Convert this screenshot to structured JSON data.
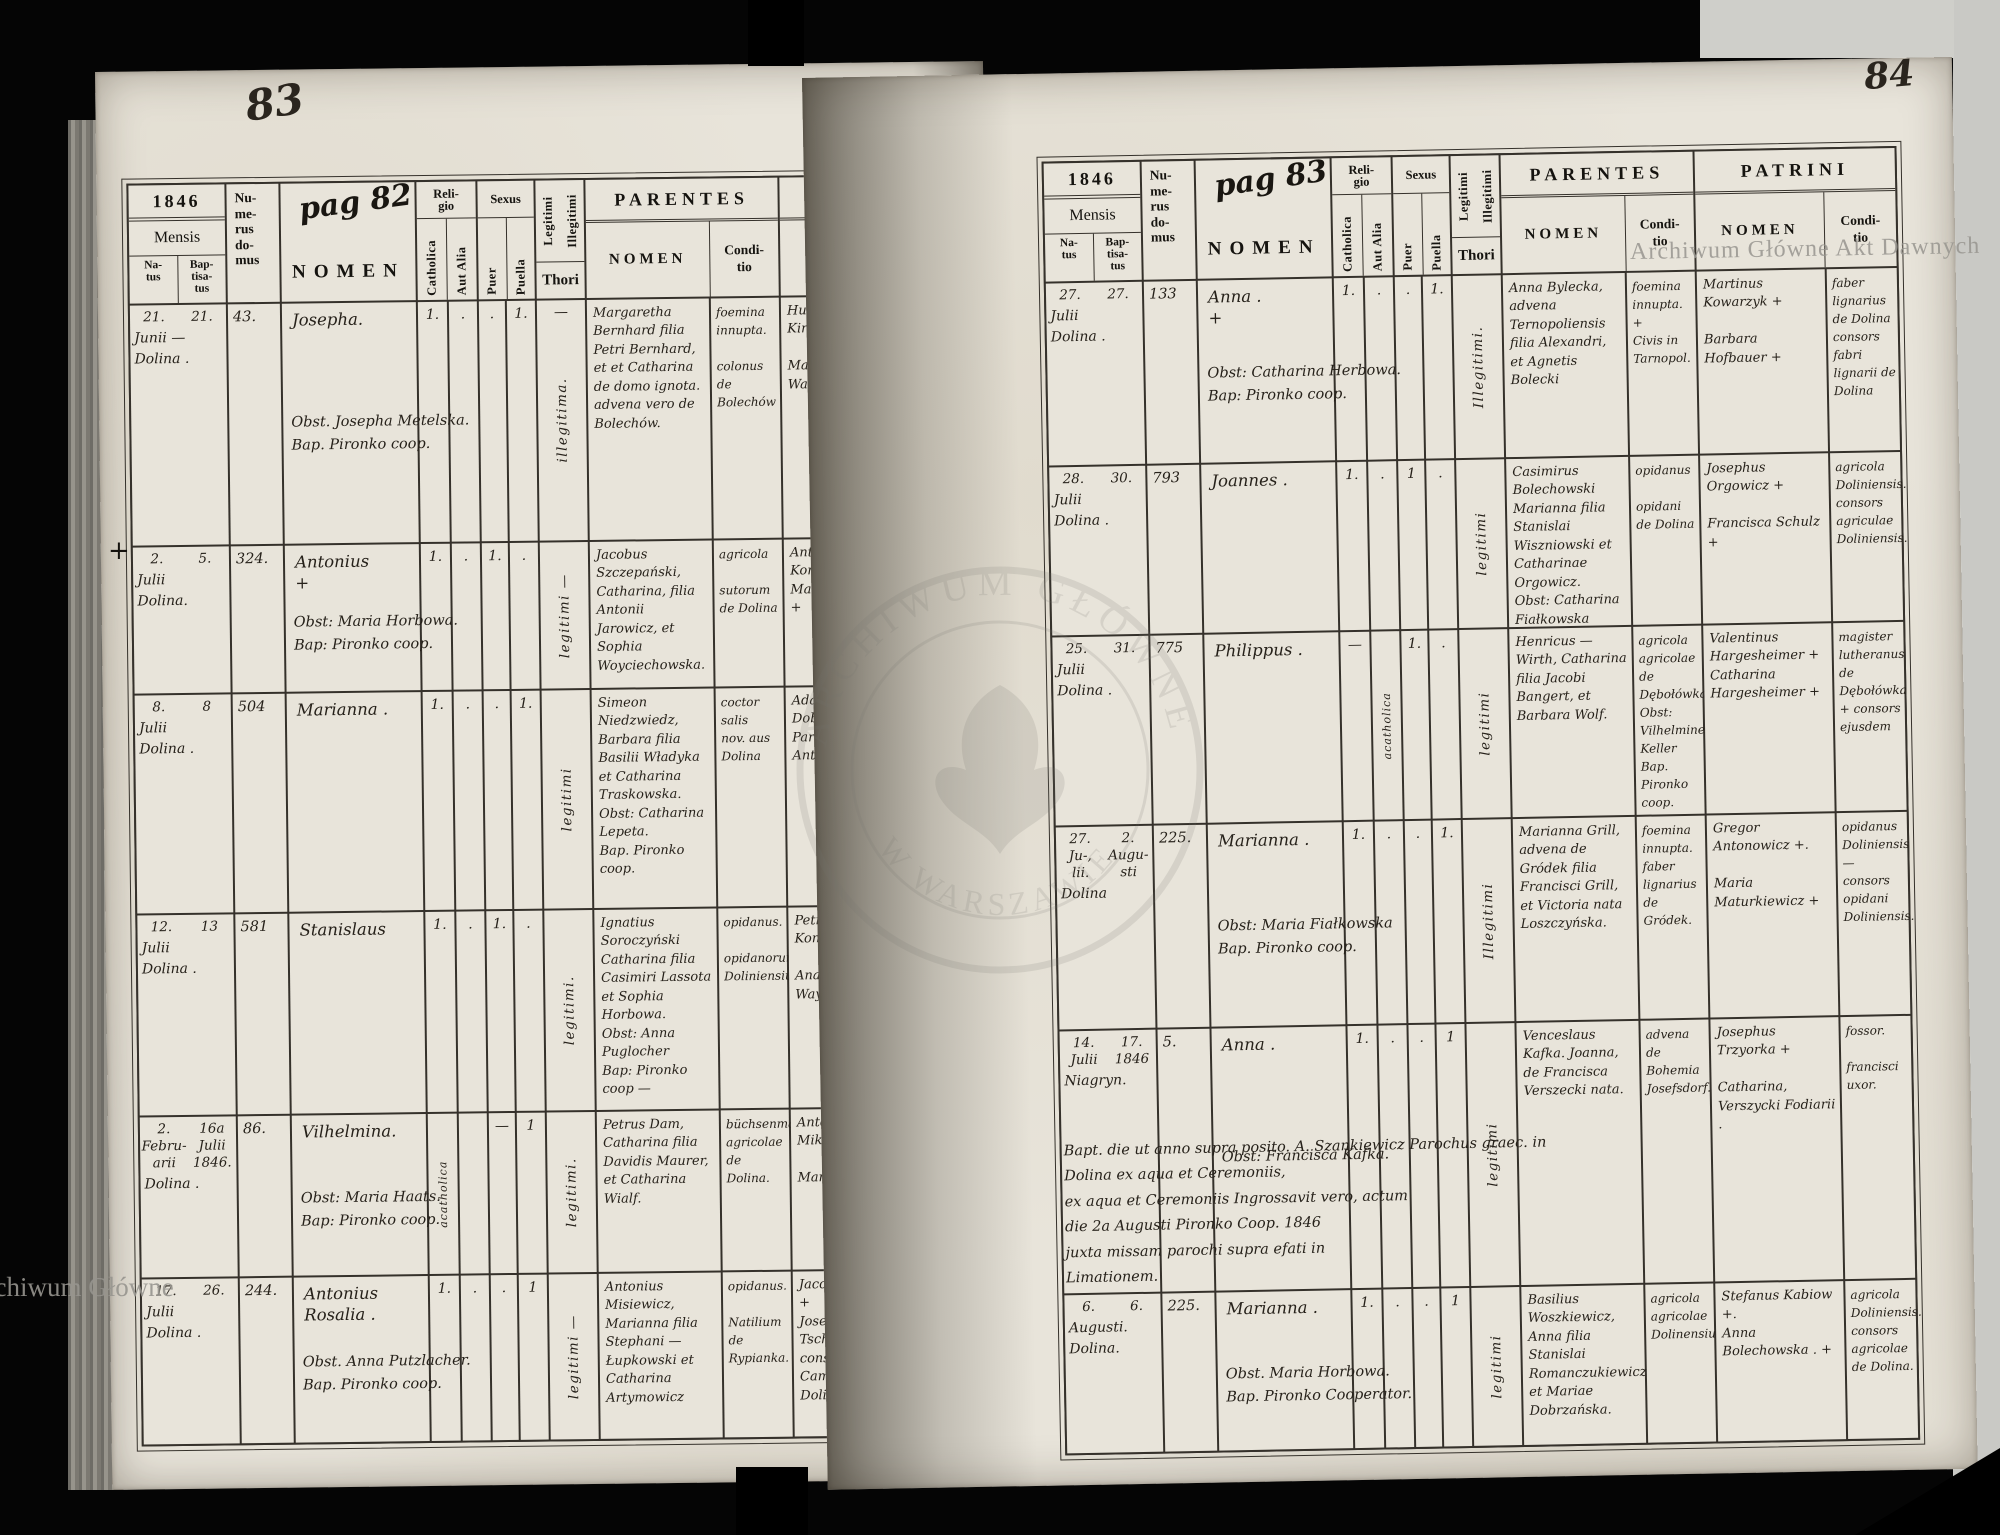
{
  "header": {
    "year": "1846",
    "mensis": "Mensis",
    "natus": "Na-\ntus",
    "baptisatus": "Bap-\ntisa-\ntus",
    "numerus": "Nu-\nme-\nrus\ndo-\nmus",
    "nomen": "NOMEN",
    "religio": "Reli-\ngio",
    "catholica": "Catholica",
    "aut_alia": "Aut Alia",
    "sexus": "Sexus",
    "puer": "Puer",
    "puella": "Puella",
    "legitimi": "Legitimi",
    "illegitimi": "Illegitimi",
    "thori": "Thori",
    "parentes": "PARENTES",
    "patrini": "PATRINI",
    "sub_nomen": "NOMEN",
    "conditio": "Condi-\ntio"
  },
  "watermarks": {
    "top_right": "Archiwum Główne Akt Dawnych",
    "bottom_left": "Archiwum Główne",
    "stamp_top": "ARCHIWUM GŁÓWNE",
    "stamp_bottom": "W WARSZAWIE"
  },
  "left_page": {
    "page_number": "83",
    "pag_note": "pag 82",
    "margin_mark": "+",
    "rows": [
      {
        "natus_day": "21.",
        "bapt_day": "21.",
        "date_rest": "Junii —\nDolina .",
        "house": "43.",
        "name": "Josepha.",
        "name_note": "Obst. Josepha Metelska.\nBap. Pironko coop.",
        "cath": "1.",
        "alia": ".",
        "puer": ".",
        "puella": "1.",
        "thori": "—",
        "legit": "illegitima.",
        "parentes": "Margaretha Bernhard filia Petri Bernhard, et et Catharina de domo ignota. advena vero de Bolechów.",
        "par_cond": "foemina innupta.\n\ncolonus de Bolechów",
        "patrini": "Hubert Kirchmaier +\n\nMagdalena Waimann +",
        "pat_cond": "pauperin der aufseher aus Dolina\ngespanis des pfleghers act Dolina"
      },
      {
        "natus_day": "2.",
        "bapt_day": "5.",
        "date_rest": "Julii\nDolina.",
        "house": "324.",
        "name": "Antonius\n      +",
        "name_note": "Obst: Maria Horbowa.\nBap:  Pironko coop.",
        "cath": "1.",
        "alia": ".",
        "puer": "1.",
        "puella": ".",
        "thori": "",
        "legit": "legitimi —",
        "parentes": "Jacobus Szczepański, Catharina, filia Antonii Jarowicz, et Sophia Woyciechowska.",
        "par_cond": "agricola\n\nsutorum de Dolina",
        "patrini": "Antonius Kordecki +\nMaria Paprocka. +",
        "pat_cond": "agricola Doliniensis.\nconsors agricolae de Dolinae"
      },
      {
        "natus_day": "8.",
        "bapt_day": "8",
        "date_rest": "Julii\nDolina .",
        "house": "504",
        "name": "Marianna .",
        "name_note": "",
        "cath": "1.",
        "alia": ".",
        "puer": ".",
        "puella": "1.",
        "thori": "",
        "legit": "legitimi",
        "parentes": "Simeon Niedzwiedz, Barbara filia Basilii Władyka et Catharina Traskowska.\nObst: Catharina Lepeta.\nBap.  Pironko coop.",
        "par_cond": "coctor salis\nnov. aus Dolina",
        "patrini": "Adalbertus Dobrański +\nParasceva Antonowicz +",
        "pat_cond": "lado de Dolina\nconsors coctoris salis de Dolina."
      },
      {
        "natus_day": "12.",
        "bapt_day": "13",
        "date_rest": "Julii\nDolina .",
        "house": "581",
        "name": "Stanislaus",
        "name_note": "",
        "cath": "1.",
        "alia": ".",
        "puer": "1.",
        "puella": ".",
        "thori": "",
        "legit": "legitimi.",
        "parentes": "Ignatius Soroczyński Catharina filia Casimiri Lassota et Sophia Horbowa.\nObst:  Anna Puglocher\nBap:  Pironko coop —",
        "par_cond": "opidanus.\n\nopidanorum Doliniensium.",
        "patrini": "Petrus Komarnicki +\n\nAnastasia Waymann +",
        "pat_cond": "opidanus Doliniensis.\nconsors adiutoris scholae trivialis Doliniensis"
      },
      {
        "natus_day": "2.\nFebru-\narii",
        "bapt_day": "16a\nJulii\n1846.",
        "date_rest": "Dolina .",
        "house": "86.",
        "name": "Vilhelmina.",
        "name_note": "Obst:  Maria Haats.\nBap:  Pironko coop.",
        "cath": "acatholica",
        "alia": "",
        "puer": "—",
        "puella": "1",
        "thori": "",
        "legit": "legitimi.",
        "parentes": "Petrus Dam, Catharina filia Davidis Maurer, et Catharina Wialf.",
        "par_cond": "büchsenmacher\nagricolae de Dolina.",
        "patrini": "Antonius Mikulski +\n\nMaria Haats +",
        "pat_cond": "sutor\n\nconsors opidani de Dolna"
      },
      {
        "natus_day": "17.",
        "bapt_day": "26.",
        "date_rest": "Julii\nDolina .",
        "house": "244.",
        "name": "Antonius\nRosalia .",
        "name_note": "Obst. Anna Putzlacher.\nBap.  Pironko coop.",
        "cath": "1.",
        "alia": ".",
        "puer": ".",
        "puella": "1",
        "thori": "",
        "legit": "legitimi —",
        "parentes": "Antonius Misiewicz, Marianna filia Stephani — Łupkowski et Catharina Artymowicz",
        "par_cond": "opidanus.\n\nNatilium de Rypianka.",
        "patrini": "Jacobus Waiman +\nJosepha Tschernek +\nconsors Camerarii civilis Dolinensis —",
        "pat_cond": "coadiutor magisterii scholae trivialis in Dolina"
      }
    ]
  },
  "right_page": {
    "page_number": "84",
    "pag_note": "pag 83",
    "rows": [
      {
        "natus_day": "27.",
        "bapt_day": "27.",
        "date_rest": "Julii\nDolina .",
        "house": "133",
        "name": "Anna .\n    +",
        "name_note": "Obst: Catharina Herbowa.\nBap:  Pironko coop.",
        "cath": "1.",
        "alia": ".",
        "puer": ".",
        "puella": "1.",
        "thori": "",
        "legit": "Illegitimi.",
        "parentes": "Anna Bylecka, advena Ternopoliensis filia Alexandri, et Agnetis Bolecki",
        "par_cond": "foemina innupta. +\nCivis in Tarnopol.",
        "patrini": "Martinus Kowarzyk +\n\nBarbara Hofbauer +",
        "pat_cond": "faber lignarius de Dolina\nconsors fabri lignarii de Dolina"
      },
      {
        "natus_day": "28.",
        "bapt_day": "30.",
        "date_rest": "Julii\nDolina .",
        "house": "793",
        "name": "Joannes .",
        "name_note": "",
        "cath": "1.",
        "alia": ".",
        "puer": "1",
        "puella": ".",
        "thori": "",
        "legit": "legitimi",
        "parentes": "Casimirus Bolechowski Marianna filia Stanislai Wiszniowski et Catharinae Orgowicz.\nObst: Catharina Fiałkowska\nBap. Pironko coop",
        "par_cond": "opidanus\n\nopidani de Dolina",
        "patrini": "Josephus Orgowicz +\n\nFrancisca Schulz +",
        "pat_cond": "agricola Doliniensis.\nconsors agriculae Doliniensis."
      },
      {
        "natus_day": "25.",
        "bapt_day": "31.",
        "date_rest": "Julii\nDolina .",
        "house": "775",
        "name": "Philippus .",
        "name_note": "",
        "cath": "—",
        "alia": "acatholica",
        "puer": "1.",
        "puella": ".",
        "thori": "",
        "legit": "legitimi",
        "parentes": "Henricus — Wirth, Catharina filia Jacobi Bangert, et Barbara Wolf.",
        "par_cond": "agricola\nagricolae de Dębołówka.\nObst: Vilhelmine Keller\nBap. Pironko coop.",
        "patrini": "Valentinus Hargesheimer +\nCatharina Hargesheimer +",
        "pat_cond": "magister lutheranus de Dębołówka\n+ consors ejusdem"
      },
      {
        "natus_day": "27.\nJu-,\nlii.",
        "bapt_day": "2.\nAugu-\nsti",
        "date_rest": "Dolina",
        "house": "225.",
        "name": "Marianna .",
        "name_note": "Obst:  Maria Fiałkowska\nBap.  Pironko coop.",
        "cath": "1.",
        "alia": ".",
        "puer": ".",
        "puella": "1.",
        "thori": "",
        "legit": "Illegitimi",
        "parentes": "Marianna Grill, advena de Gródek filia Francisci Grill, et Victoria nata Loszczyńska.",
        "par_cond": "foemina innupta.\nfaber lignarius de Gródek.",
        "patrini": "Gregor Antonowicz +.\n\nMaria Maturkiewicz +",
        "pat_cond": "opidanus Doliniensis —\nconsors opidani Doliniensis."
      },
      {
        "natus_day": "14.\nJulii",
        "bapt_day": "17.\n1846",
        "date_rest": "Niagryn.",
        "house": "5.",
        "name": "Anna .",
        "name_note": "Obst: Francisca Kafka.",
        "note": "Bapt. die ut anno supra posito. A. Szankiewicz Parochus graec. in Dolina ex aqua et Ceremoniis,\nex aqua et Ceremoniis Ingrossavit vero, actum\ndie 2a Augusti Pironko Coop. 1846\njuxta missam parochi supra efati in\nLimationem.",
        "cath": "1.",
        "alia": ".",
        "puer": ".",
        "puella": "1",
        "thori": "",
        "legit": "legitimi",
        "parentes": "Venceslaus Kafka. Joanna, de Francisca Verszecki nata.",
        "par_cond": "advena de Bohemia Josefsdorf.",
        "patrini": "Josephus Trzyorka +\n\nCatharina, Verszycki Fodiarii .",
        "pat_cond": "fossor.\n\nfrancisci uxor."
      },
      {
        "natus_day": "6.",
        "bapt_day": "6.",
        "date_rest": "Augusti.\nDolina.",
        "house": "225.",
        "name": "Marianna .",
        "name_note": "Obst. Maria Horbowa.\nBap. Pironko Cooperator.",
        "cath": "1.",
        "alia": ".",
        "puer": ".",
        "puella": "1",
        "thori": "",
        "legit": "legitimi",
        "parentes": "Basilius Woszkiewicz, Anna filia Stanislai Romanczukiewicz et Mariae Dobrzańska.",
        "par_cond": "agricola\nagricolae Dolinensium",
        "patrini": "Stefanus Kabiow +.\nAnna Bolechowska . +",
        "pat_cond": "agricola Doliniensis.\nconsors agricolae de Dolina."
      }
    ]
  }
}
